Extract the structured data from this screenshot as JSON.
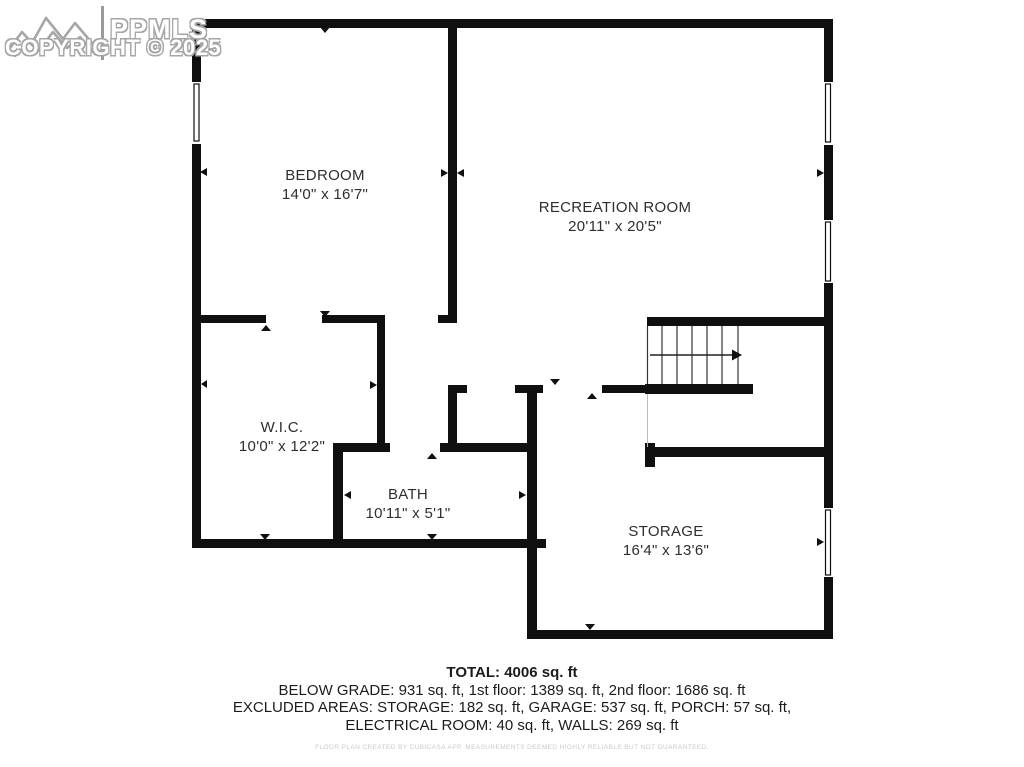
{
  "logo": {
    "brand": "PPMLS",
    "copyright": "COPYRIGHT © 2025"
  },
  "rooms": [
    {
      "name": "BEDROOM",
      "dims": "14'0\" x 16'7\""
    },
    {
      "name": "RECREATION ROOM",
      "dims": "20'11\" x 20'5\""
    },
    {
      "name": "W.I.C.",
      "dims": "10'0\" x 12'2\""
    },
    {
      "name": "BATH",
      "dims": "10'11\" x 5'1\""
    },
    {
      "name": "STORAGE",
      "dims": "16'4\" x 13'6\""
    }
  ],
  "summary": {
    "total": "TOTAL: 4006 sq. ft",
    "line2": "BELOW GRADE: 931 sq. ft, 1st floor: 1389 sq. ft, 2nd floor: 1686 sq. ft",
    "line3": "EXCLUDED AREAS: STORAGE: 182 sq. ft, GARAGE: 537 sq. ft, PORCH: 57 sq. ft,",
    "line4": "ELECTRICAL ROOM: 40 sq. ft, WALLS: 269 sq. ft",
    "disclaimer": "FLOOR PLAN CREATED BY CUBICASA APP. MEASUREMENTS DEEMED HIGHLY RELIABLE BUT NOT GUARANTEED."
  },
  "colors": {
    "wall": "#0f0f0f",
    "label_text": "#2e2e2e",
    "logo_outline": "#a6a6a6",
    "disclaimer_text": "#c9c9c9"
  }
}
